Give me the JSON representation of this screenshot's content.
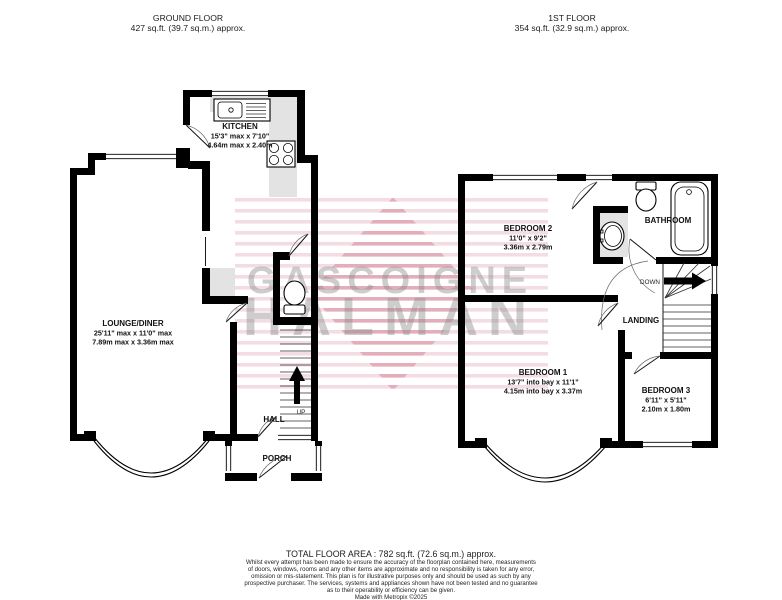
{
  "page": {
    "background": "#ffffff"
  },
  "headers": {
    "ground": {
      "title": "GROUND FLOOR",
      "area": "427 sq.ft. (39.7 sq.m.) approx."
    },
    "first": {
      "title": "1ST FLOOR",
      "area": "354 sq.ft. (32.9 sq.m.) approx."
    }
  },
  "ground_floor": {
    "kitchen": {
      "name": "KITCHEN",
      "imperial": "15'3\" max x 7'10\"",
      "metric": "4.64m max x 2.40m"
    },
    "lounge": {
      "name": "LOUNGE/DINER",
      "imperial": "25'11\" max x 11'0\" max",
      "metric": "7.89m max x 3.36m max"
    },
    "hall": {
      "name": "HALL"
    },
    "porch": {
      "name": "PORCH"
    },
    "stairs": {
      "label": "UP"
    }
  },
  "first_floor": {
    "bedroom2": {
      "name": "BEDROOM 2",
      "imperial": "11'0\" x 9'2\"",
      "metric": "3.36m x 2.79m"
    },
    "bathroom": {
      "name": "BATHROOM"
    },
    "landing": {
      "name": "LANDING"
    },
    "bedroom1": {
      "name": "BEDROOM 1",
      "imperial": "13'7\" into bay x 11'1\"",
      "metric": "4.15m into bay x 3.37m"
    },
    "bedroom3": {
      "name": "BEDROOM 3",
      "imperial": "6'11\" x 5'11\"",
      "metric": "2.10m x 1.80m"
    },
    "stairs": {
      "label": "DOWN"
    }
  },
  "watermark": {
    "line1": "GASCOIGNE",
    "line2": "HALMAN",
    "text_color": "#878787",
    "stripe_color": "#d98fa0"
  },
  "footer": {
    "total": "TOTAL FLOOR AREA : 782 sq.ft. (72.6 sq.m.) approx.",
    "disclaimer": [
      "Whilst every attempt has been made to ensure the accuracy of the floorplan contained here, measurements",
      "of doors, windows, rooms and any other items are approximate and no responsibility is taken for any error,",
      "omission or mis-statement. This plan is for illustrative purposes only and should be used as such by any",
      "prospective purchaser. The services, systems and appliances shown have not been tested and no guarantee",
      "as to their operability or efficiency can be given."
    ],
    "credit": "Made with Metropix ©2025"
  }
}
